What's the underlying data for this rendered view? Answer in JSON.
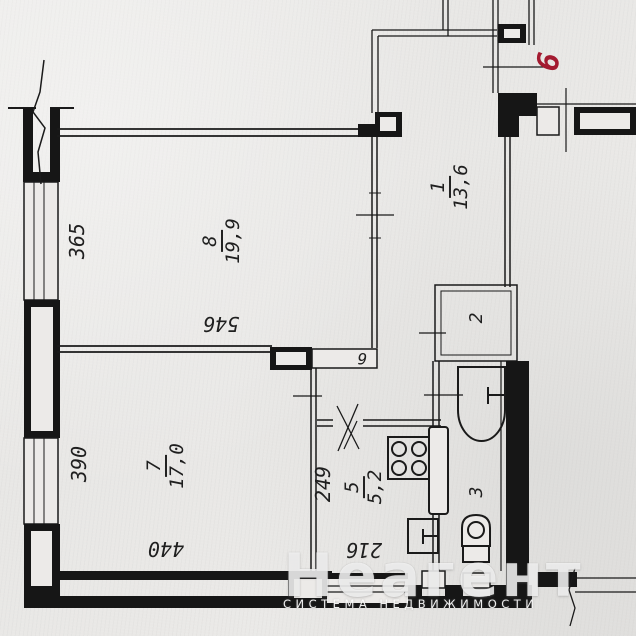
{
  "plan": {
    "apartment_number": "6",
    "rooms": {
      "living": {
        "number": "8",
        "area": "19,9"
      },
      "bedroom": {
        "number": "7",
        "area": "17,0"
      },
      "hall_room": {
        "number": "1",
        "area": "13,6"
      },
      "kitchen": {
        "number": "5",
        "area": "5,2"
      },
      "closet": {
        "number": "2"
      },
      "bathroom": {
        "number": "3"
      },
      "corridor": {
        "number": "6"
      }
    },
    "dimensions": {
      "left_top": "365",
      "left_bottom": "390",
      "living_width": "546",
      "bedroom_width": "440",
      "kitchen_depth": "249",
      "kitchen_width": "216"
    },
    "colors": {
      "ink": "#1f1f1f",
      "red": "#a31a30",
      "paper": "#e8e7e5"
    }
  },
  "watermark": {
    "title": "Неагент",
    "subtitle": "СИСТЕМА НЕДВИЖИМОСТИ"
  }
}
